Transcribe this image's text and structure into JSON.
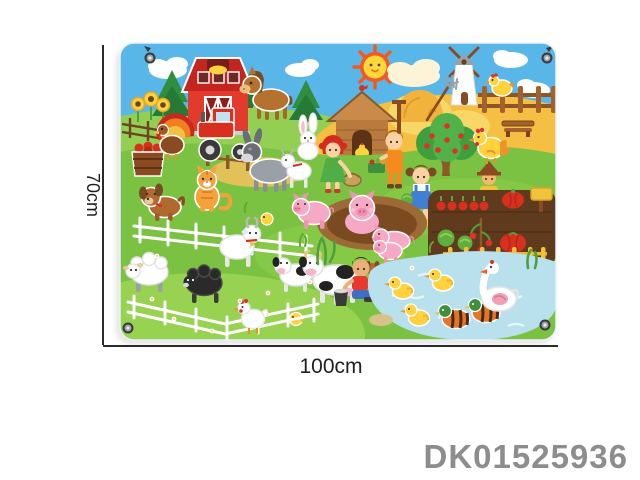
{
  "product_code": {
    "value": "DK01525936",
    "color": "#8d8d8d"
  },
  "annotations": {
    "height_label": "70cm",
    "width_label": "100cm",
    "line_color": "#2b2b2b"
  },
  "board": {
    "kind": "felt farm-scene wall play mat with corner grommets",
    "grommet_count": 4,
    "colors": {
      "sky": "#58b6e9",
      "grass": "#7cc242",
      "grass_light": "#9ad453",
      "hill": "#93cf52",
      "wheat_field": "#f4bf42",
      "barn_red": "#d93227",
      "pond": "#b9e1ed",
      "mud": "#7a4a21",
      "garden_soil": "#5f3a1c",
      "fence_brown": "#a3622c",
      "fence_yellow": "#f2c23c",
      "pig_pink": "#f6a9c5"
    },
    "scene_elements": [
      "sun with face",
      "clouds",
      "red barn",
      "windmill",
      "pine trees",
      "brown horse",
      "sunflowers",
      "turkey",
      "red tractor",
      "barrel of apples",
      "wooden chicken coop",
      "haystack with pitchfork",
      "brown fence",
      "yellow hen on fence",
      "apple tree",
      "yellow rooster",
      "wooden bench",
      "boy with vegetable basket",
      "red-haired girl with basket",
      "girl with cabbage",
      "scarecrow",
      "vegetable garden",
      "carrot row",
      "cabbages",
      "tomato plant",
      "red pumpkins",
      "garden sign",
      "yellow garden fence",
      "pigs in mud puddle",
      "donkey",
      "white rabbit",
      "goat kid",
      "goat with horns",
      "orange cat",
      "brown dog",
      "yellow chicks",
      "white rail fences",
      "white sheep",
      "black sheep",
      "cow and calf",
      "boy milking cow",
      "milk bucket",
      "puppy",
      "piglet",
      "pond with waves",
      "yellow ducks",
      "mandarin ducks",
      "white goose",
      "white hen",
      "reeds",
      "daisies"
    ]
  }
}
